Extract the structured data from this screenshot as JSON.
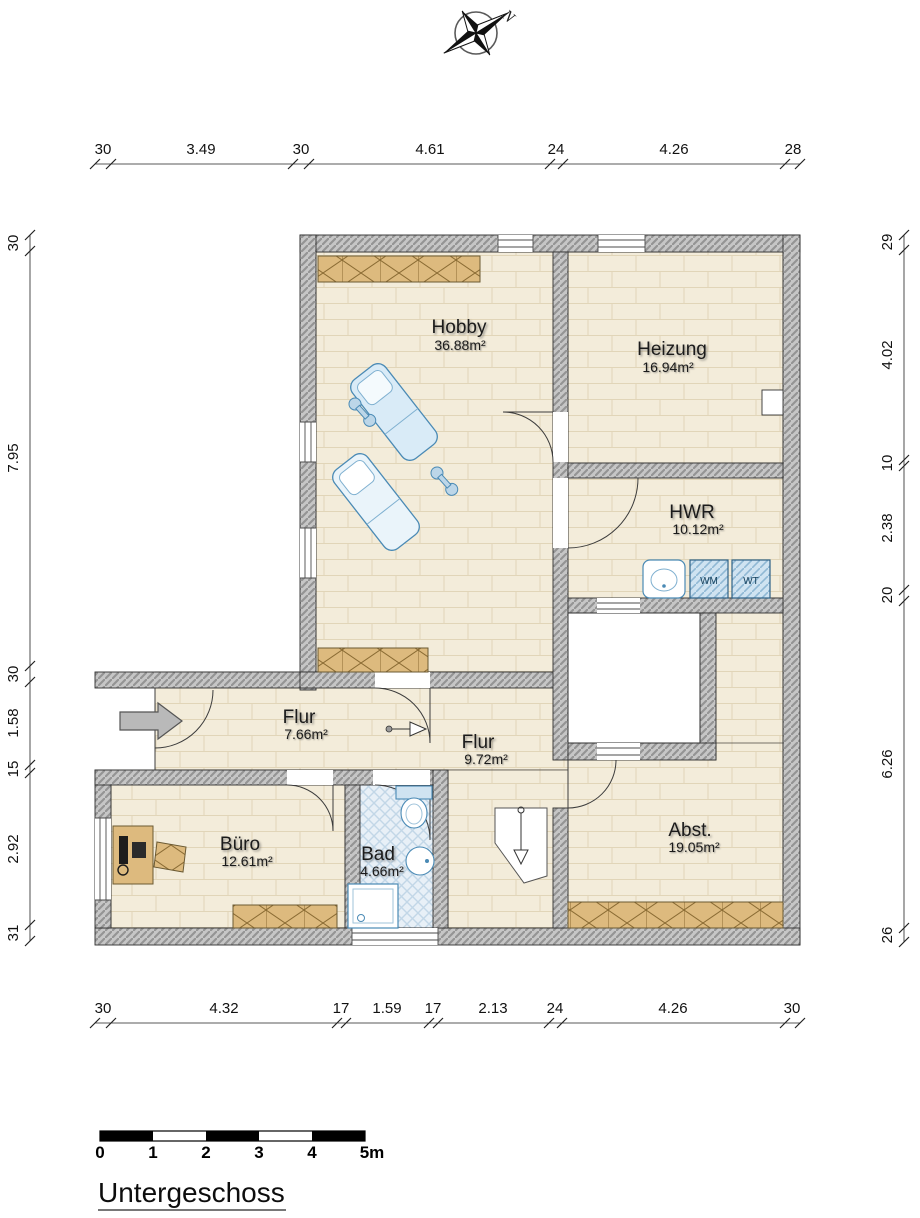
{
  "title": "Untergeschoss",
  "compass": {
    "label": "N"
  },
  "dimensions": {
    "top": [
      "30",
      "3.49",
      "30",
      "4.61",
      "24",
      "4.26",
      "28"
    ],
    "bottom": [
      "30",
      "4.32",
      "17",
      "1.59",
      "17",
      "2.13",
      "24",
      "4.26",
      "30"
    ],
    "left": [
      "30",
      "7.95",
      "30",
      "1.58",
      "15",
      "2.92",
      "31"
    ],
    "right": [
      "29",
      "4.02",
      "10",
      "2.38",
      "20",
      "6.26",
      "26"
    ]
  },
  "rooms": {
    "hobby": {
      "name": "Hobby",
      "area": "36.88m²"
    },
    "heizung": {
      "name": "Heizung",
      "area": "16.94m²"
    },
    "hwr": {
      "name": "HWR",
      "area": "10.12m²"
    },
    "flur1": {
      "name": "Flur",
      "area": "7.66m²"
    },
    "flur2": {
      "name": "Flur",
      "area": "9.72m²"
    },
    "buero": {
      "name": "Büro",
      "area": "12.61m²"
    },
    "bad": {
      "name": "Bad",
      "area": "4.66m²"
    },
    "abst": {
      "name": "Abst.",
      "area": "19.05m²"
    }
  },
  "appliances": {
    "wm": "WM",
    "wt": "WT"
  },
  "scale_bar": {
    "labels": [
      "0",
      "1",
      "2",
      "3",
      "4",
      "5m"
    ]
  },
  "colors": {
    "floor": "#f3ecda",
    "wall": "#c6c6c6",
    "furniture": "#ddba7e",
    "fixture_blue": "#cfe3f1",
    "accent_blue": "#4a8ab5"
  }
}
